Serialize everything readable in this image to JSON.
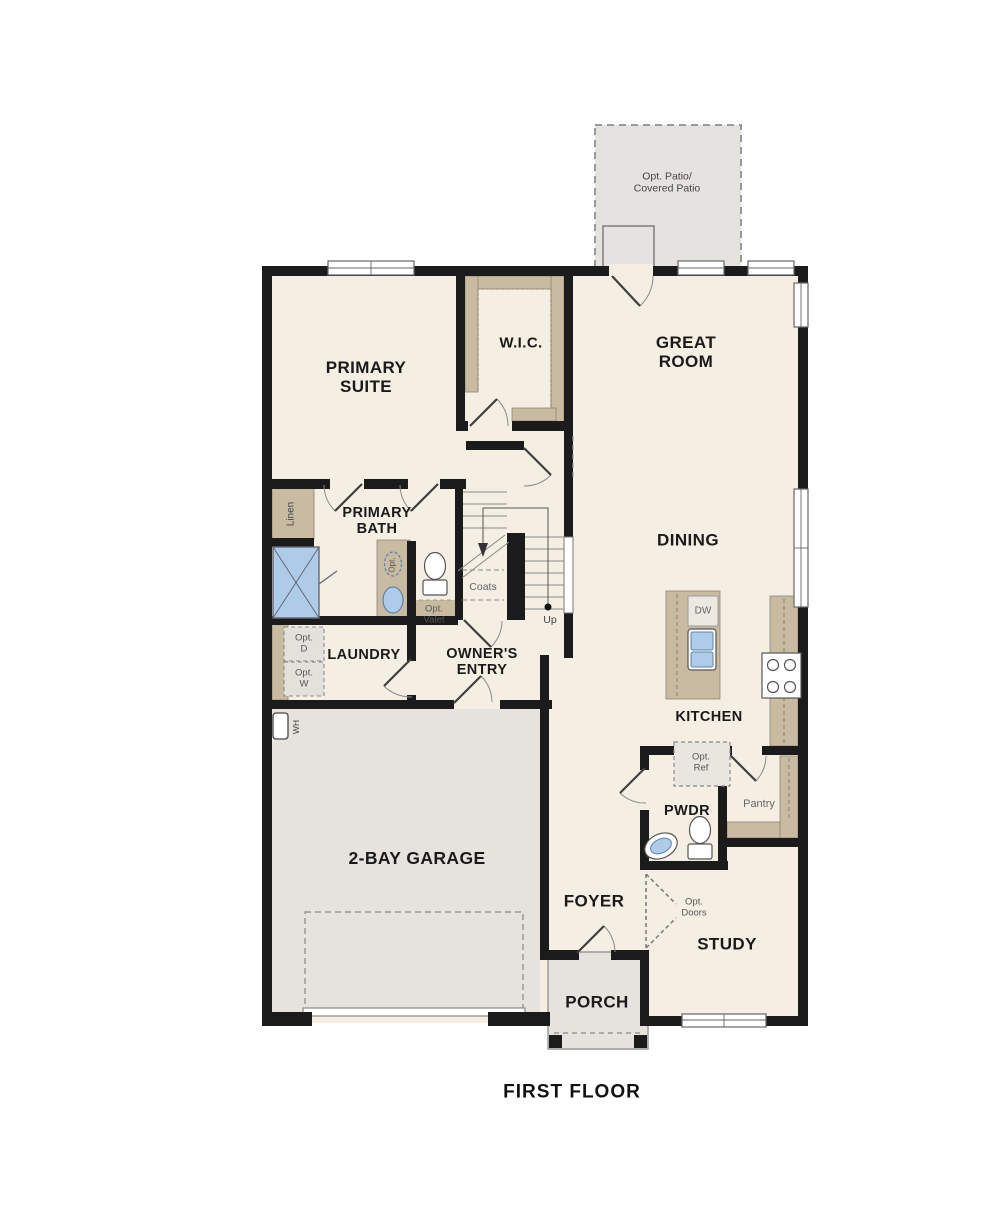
{
  "plan": {
    "floor_title": "FIRST FLOOR",
    "labels": {
      "opt_patio": "Opt. Patio/\nCovered Patio",
      "primary_suite": "PRIMARY\nSUITE",
      "wic": "W.I.C.",
      "great_room": "GREAT\nROOM",
      "linen": "Linen",
      "primary_bath": "PRIMARY\nBATH",
      "dining": "DINING",
      "coats": "Coats",
      "up": "Up",
      "opt_valet": "Opt.\nValet",
      "opt_sink": "Opt.",
      "laundry": "LAUNDRY",
      "owners_entry": "OWNER'S\nENTRY",
      "opt_dryer": "Opt.\nD",
      "opt_washer": "Opt.\nW",
      "water_heater": "WH",
      "kitchen": "KITCHEN",
      "dishwasher": "DW",
      "opt_ref": "Opt.\nRef",
      "pwdr": "PWDR",
      "pantry": "Pantry",
      "garage": "2-BAY GARAGE",
      "foyer": "FOYER",
      "opt_doors": "Opt.\nDoors",
      "study": "STUDY",
      "porch": "PORCH"
    },
    "colors": {
      "wall": "#1b1b1b",
      "floor": "#f5efe3",
      "concrete": "#e6e3de",
      "casework": "#c9baa2",
      "plumbing_blue": "#aecce7",
      "line_gray": "#888888"
    }
  }
}
